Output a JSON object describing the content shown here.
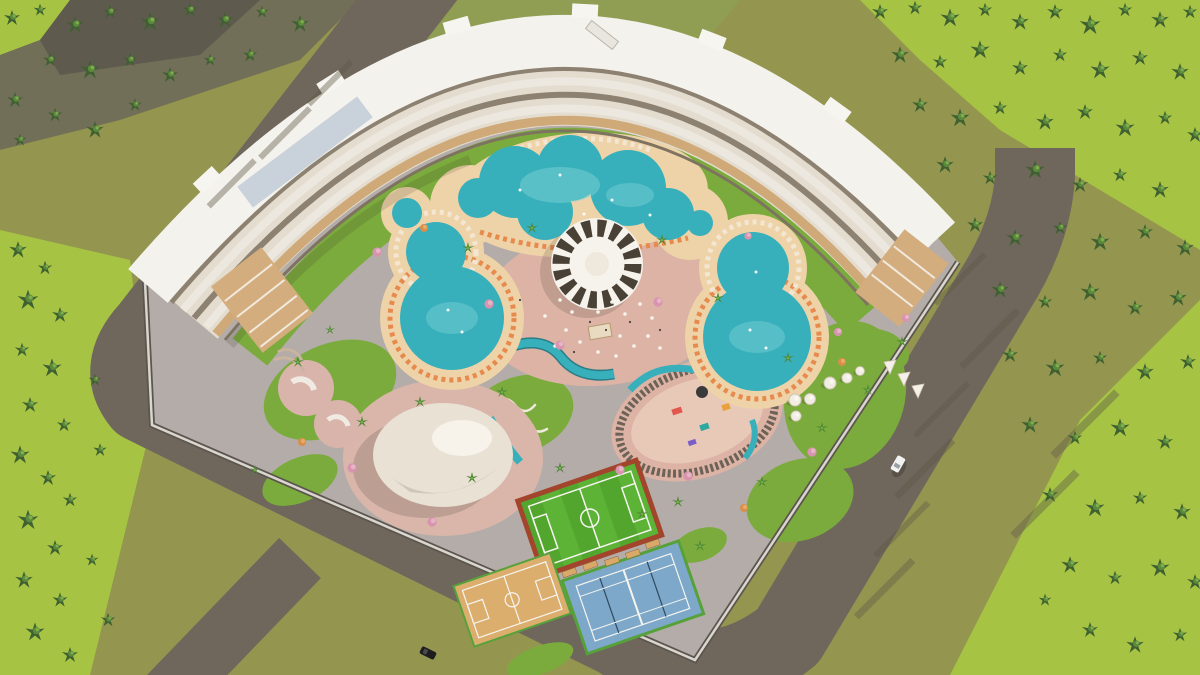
{
  "meta": {
    "title": "Aerial 3D architectural render of a curved resort hotel complex",
    "type": "architectural-visualization",
    "width_px": 1200,
    "height_px": 675,
    "visible_text": "none"
  },
  "palette": {
    "base_olive": "#94964f",
    "field_smooth": "#8f9e52",
    "grass_bright": "#a6c344",
    "ground_dark": "#716f57",
    "corner_dark": "#5e5a4e",
    "road": "#6f675c",
    "paving": "#b3aca8",
    "pink_paving": "#dcb3a4",
    "pink_light": "#e8c9b8",
    "pink_zone": "#d9b6a9",
    "deck": "#eed3a9",
    "pool": "#38b0bb",
    "pool_light": "#85d4d6",
    "pool_deep": "#2a7d86",
    "lawn": "#7cab3d",
    "roof_white": "#f4f2ec",
    "facade_base": "#e4ddcf",
    "facade_tan": "#cfa978",
    "facade_inner": "#7e7260",
    "skylight": "#c9d2da",
    "terrace_wood": "#d4ad7e",
    "wall_dark": "#5b554d",
    "wall_light": "#d9d5cf",
    "canopy_white": "#f6f3ec",
    "canopy_dark": "#4a4136",
    "dome_body": "#e8e1d4",
    "dome_shade": "#cfc7b8",
    "pitch_green": "#5cb335",
    "pitch_green_dark": "#52a62e",
    "pitch_border": "#a3452c",
    "court_wood": "#dcae6e",
    "court_blue": "#7ea8ca",
    "court_border_green": "#57a13b",
    "bench_tan": "#d9a96a",
    "lounger_orange": "#e78a4e",
    "boardwalk": "#6d6257",
    "tree_pink": "#d893af",
    "tree_orange": "#d78f4a",
    "palm_green": "#4f8735",
    "car_black": "#1d1d1f",
    "car_white": "#f2f2f2"
  },
  "scene": {
    "environment": {
      "surroundings": "pine forest on left, top-left, top-right and right; olive-green open fields bottom-left",
      "roads": "grey perimeter road wrapping west, south and east sides with branch to bottom-left corner"
    },
    "building": {
      "name": "curved hotel block",
      "description": "white-roofed crescent building arcing along the north edge with terraced tan balcony facade facing the pools",
      "wings": [
        "west wing terraces",
        "east wing terraces"
      ]
    },
    "pools": [
      {
        "name": "lagoon-pool",
        "description": "large freeform lagoon pool top-center with beige sun deck and loungers"
      },
      {
        "name": "west-figure8-pool",
        "description": "figure-eight pool on the west side ringed by striped loungers"
      },
      {
        "name": "east-figure8-pool",
        "description": "figure-eight pool on the east side ringed by striped loungers"
      },
      {
        "name": "kids-pool-west",
        "description": "small round pool near west pool"
      },
      {
        "name": "kids-pool-east",
        "description": "small round pool near lagoon"
      }
    ],
    "amenities": [
      {
        "name": "central-canopy",
        "description": "round white shade canopy with dark radial rim slats at the heart of the plaza"
      },
      {
        "name": "plaza-dining",
        "description": "pink paved plaza with scattered white umbrellas and tables"
      },
      {
        "name": "event-dome",
        "description": "large white dome tent south-west of the plaza"
      },
      {
        "name": "playground",
        "description": "pink playground loop with boardwalk ring and water channel"
      },
      {
        "name": "lazy-river",
        "description": "winding teal water channel"
      },
      {
        "name": "zen-garden",
        "description": "lawn with white serpentine paths"
      },
      {
        "name": "skate-park",
        "description": "pink skate pads with white ramps near west wall"
      },
      {
        "name": "glamping-domes",
        "description": "cluster of small white dome tents and teepees on east lawn"
      }
    ],
    "sports": [
      {
        "name": "football-pitch",
        "surface": "green turf with red-brown border"
      },
      {
        "name": "basketball-court",
        "surface": "wood-tone court with white markings"
      },
      {
        "name": "tennis-court",
        "surface": "blue hard court, two courts, white markings, green border"
      }
    ],
    "vehicles": [
      {
        "name": "black-car",
        "location": "south road, bottom-left"
      },
      {
        "name": "white-car",
        "location": "east road, right side"
      }
    ]
  }
}
